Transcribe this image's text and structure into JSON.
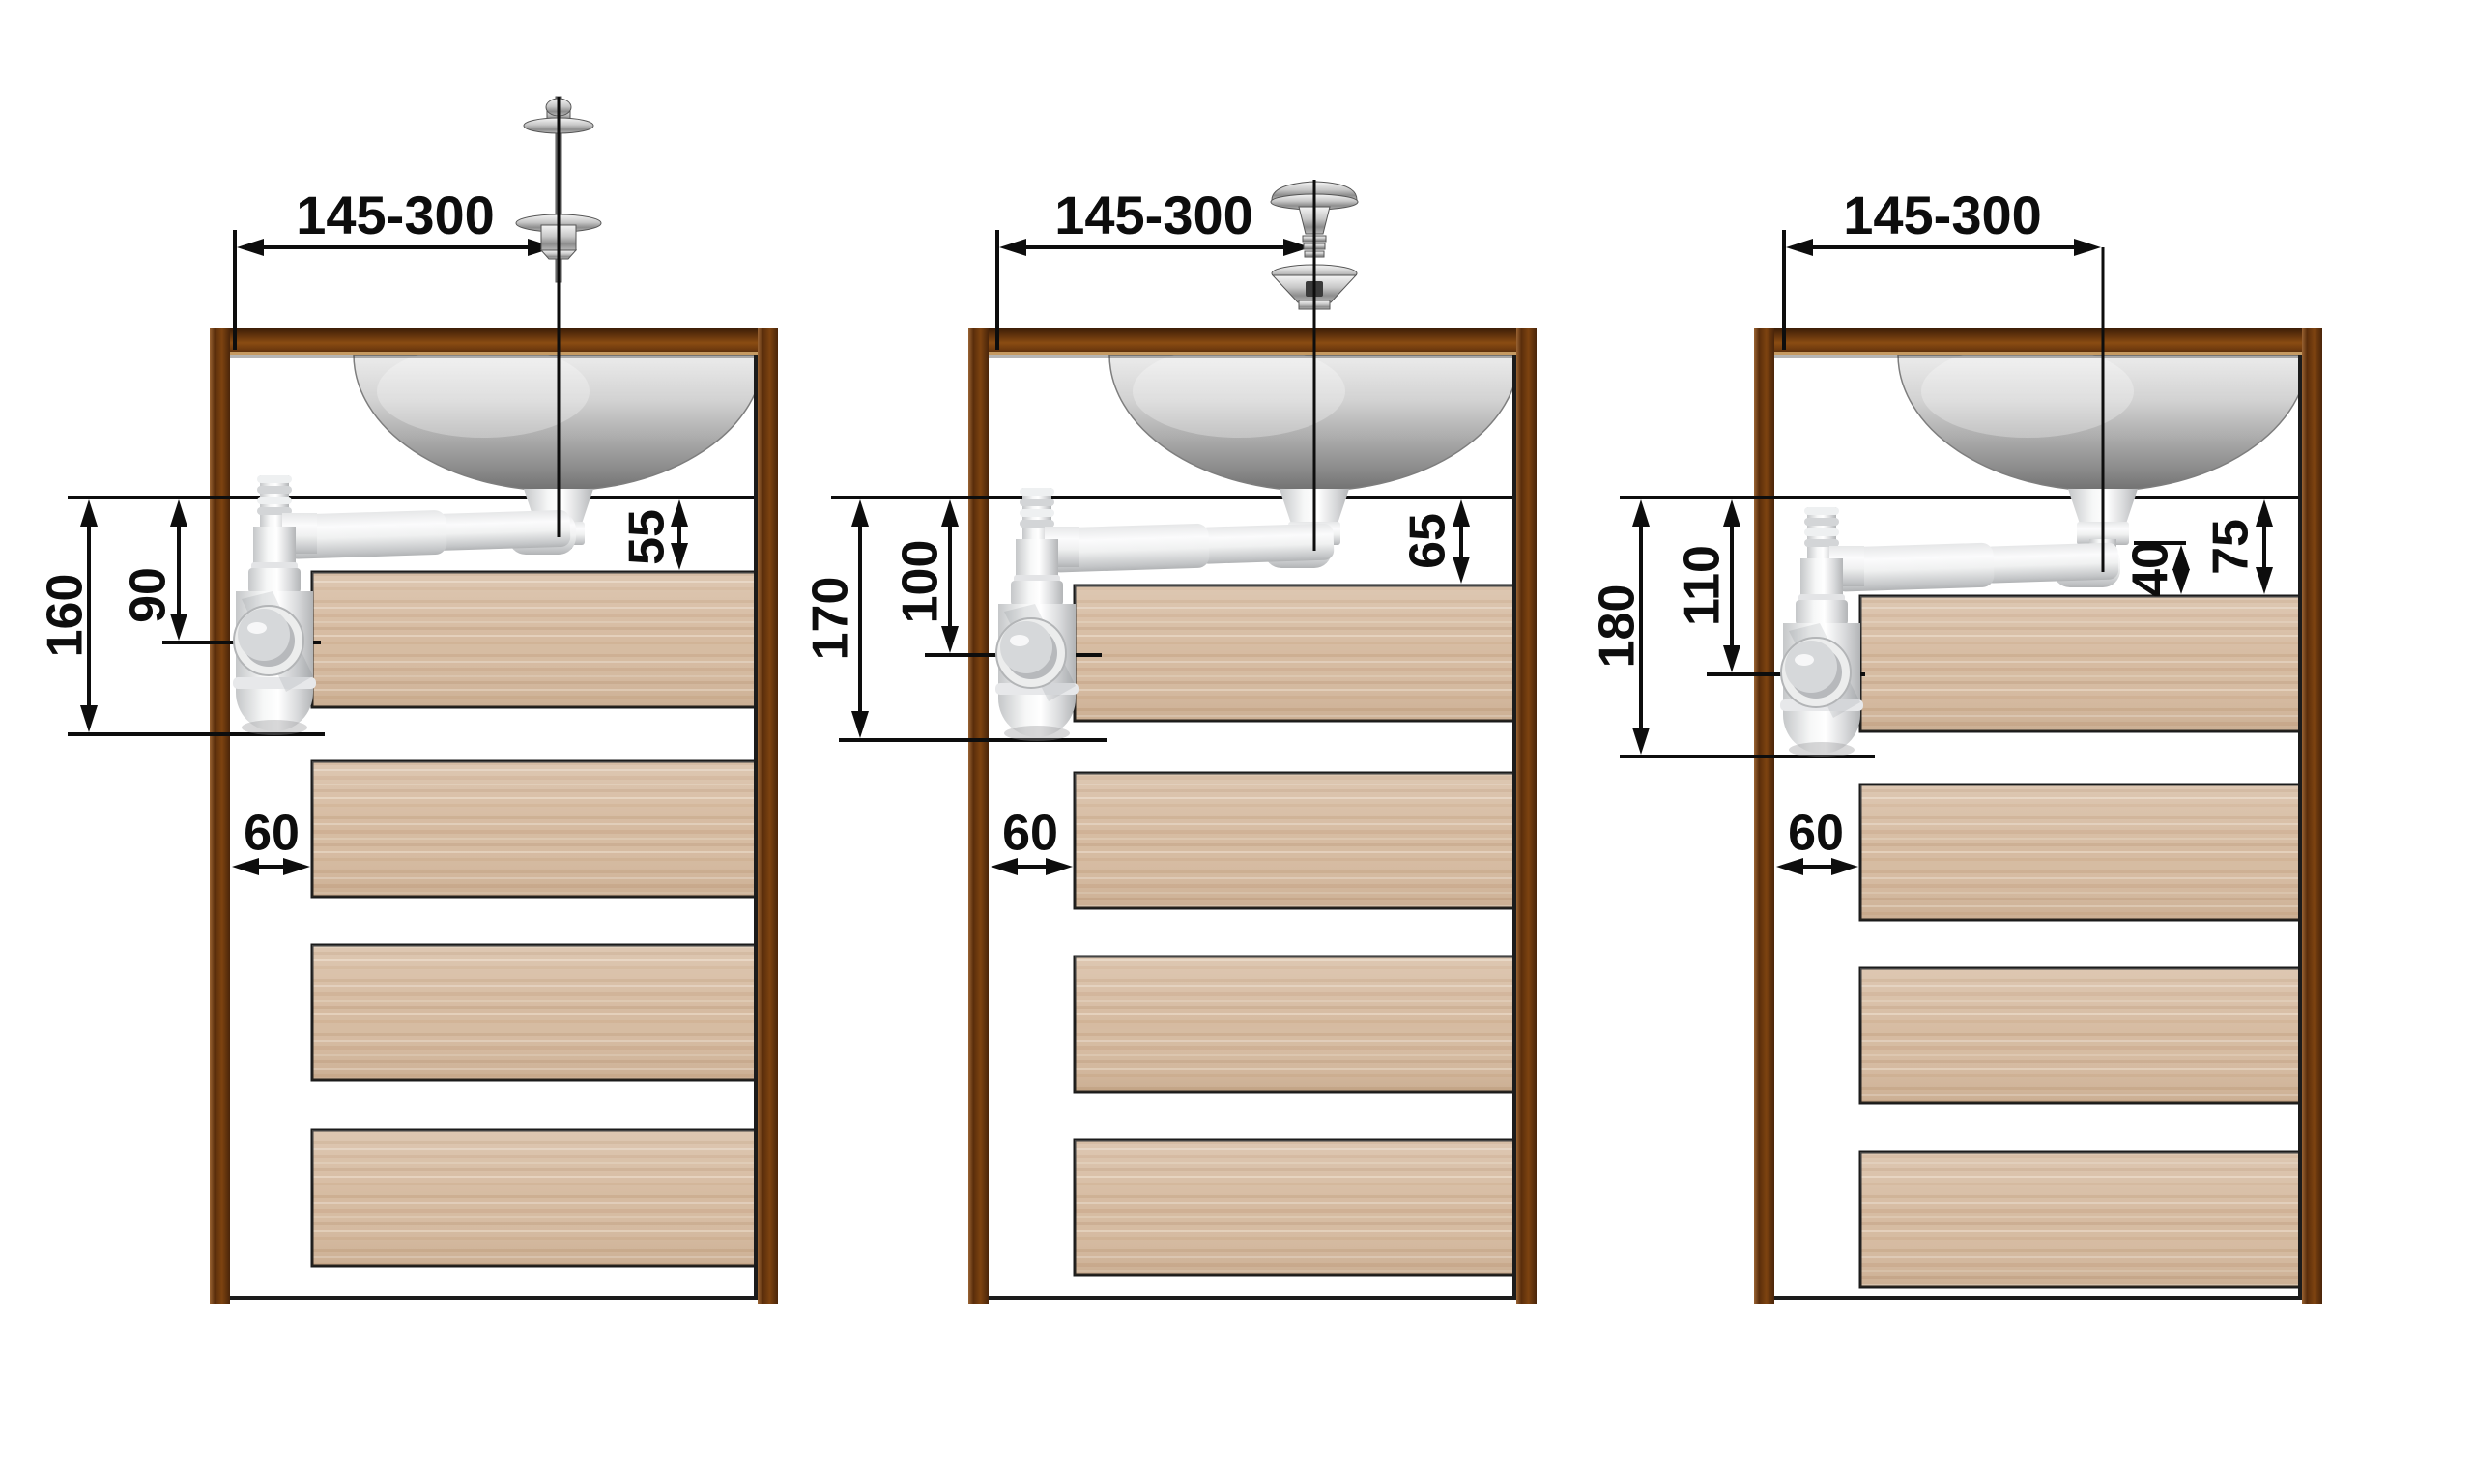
{
  "diagram": {
    "type": "plumbing-installation-drawing",
    "subject": "bottle-trap siphon mounting heights under a countertop basin in a drawer cabinet",
    "colors": {
      "background": "#ffffff",
      "frame_brown": "#7d4310",
      "frame_brown_dark": "#42220a",
      "wood_light": "#d6bba1",
      "dimension_line": "#0d0d0d",
      "pipe_white": "#f4f5f6",
      "sink_steel": "#9a9a9a"
    },
    "panels": [
      {
        "name": "variant-1",
        "range_label": "145-300",
        "drain_to_shelf_label": "55",
        "drain_to_trap_outlet_label": "90",
        "drain_to_trap_bottom_label": "160",
        "wall_offset_label": "60"
      },
      {
        "name": "variant-2",
        "range_label": "145-300",
        "drain_to_shelf_label": "65",
        "drain_to_trap_outlet_label": "100",
        "drain_to_trap_bottom_label": "170",
        "wall_offset_label": "60"
      },
      {
        "name": "variant-3",
        "range_label": "145-300",
        "drain_to_shelf_label": "75",
        "pipe_to_shelf_label": "40",
        "drain_to_trap_outlet_label": "110",
        "drain_to_trap_bottom_label": "180",
        "wall_offset_label": "60"
      }
    ]
  }
}
